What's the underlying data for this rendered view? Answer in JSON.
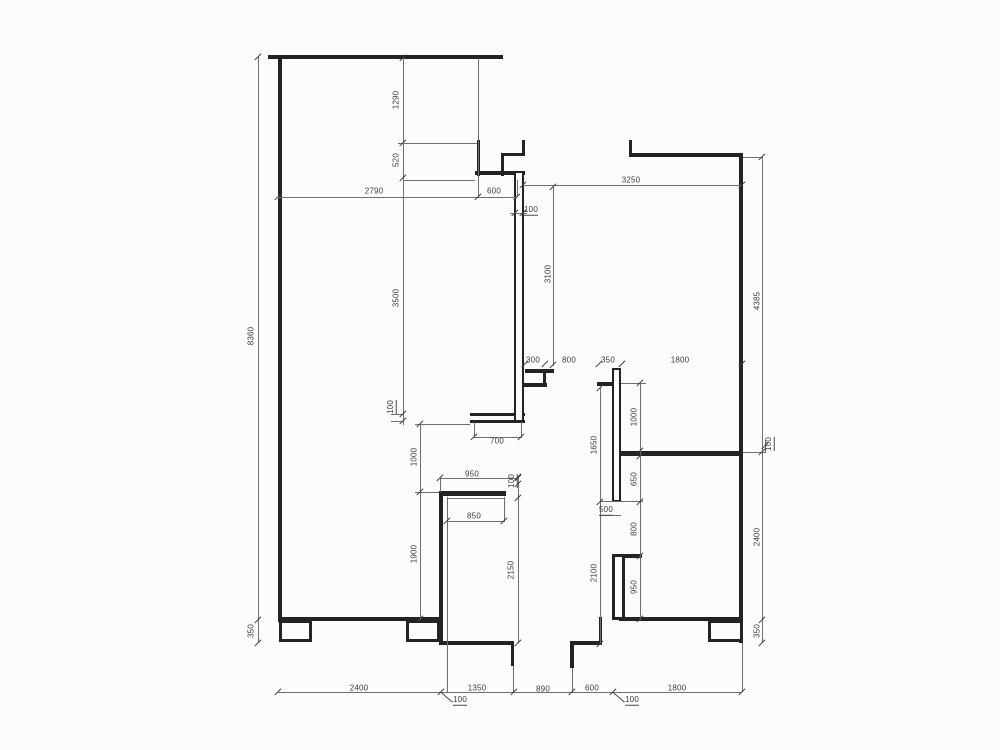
{
  "meta": {
    "drawing_type": "apartment-floor-plan-with-dimensions",
    "units": "mm"
  },
  "canvas": {
    "width": 1000,
    "height": 750,
    "background": "#fcfcfa",
    "wall_color": "#232323",
    "line_color": "#6e6e6e",
    "text_color": "#3c3c3c"
  },
  "plan": {
    "walls_h": [
      [
        268,
        55,
        503,
        4
      ],
      [
        501,
        153,
        525,
        3
      ],
      [
        475,
        171,
        525,
        4
      ],
      [
        629,
        153,
        743,
        4
      ],
      [
        470,
        413,
        525,
        3
      ],
      [
        470,
        420,
        525,
        2.5
      ],
      [
        525,
        369,
        554,
        3.5
      ],
      [
        523,
        383,
        547,
        3.5
      ],
      [
        597,
        382,
        621,
        3.5
      ],
      [
        618,
        451,
        743,
        4.5
      ],
      [
        612,
        554,
        642,
        3.5
      ],
      [
        439,
        491,
        506,
        4.5
      ],
      [
        443,
        641,
        514,
        3.5
      ],
      [
        570,
        641,
        602,
        3.5
      ],
      [
        278,
        617,
        441,
        4
      ],
      [
        619,
        617,
        743,
        4
      ]
    ],
    "walls_v": [
      [
        278,
        55,
        622,
        4
      ],
      [
        477,
        140,
        176,
        3
      ],
      [
        521.5,
        140,
        156,
        3
      ],
      [
        501,
        153,
        176,
        3
      ],
      [
        629,
        140,
        157,
        3
      ],
      [
        738.5,
        154,
        643,
        4.5
      ],
      [
        543,
        369,
        387,
        3
      ],
      [
        439,
        491,
        645,
        4
      ],
      [
        510.5,
        643,
        666,
        3.5
      ],
      [
        570,
        643,
        668,
        3.5
      ],
      [
        598.5,
        617,
        645,
        3.5
      ]
    ],
    "wall_boxes": [
      [
        514,
        171,
        10,
        251,
        2.5
      ],
      [
        612,
        368,
        9,
        134,
        2.5
      ],
      [
        612,
        554,
        13,
        66,
        3
      ],
      [
        279,
        620,
        33,
        22,
        3
      ],
      [
        406,
        620,
        34,
        22,
        3
      ],
      [
        708,
        620,
        35,
        22,
        3
      ]
    ],
    "ext_v": [
      [
        258,
        57,
        643
      ],
      [
        402.5,
        57,
        425
      ],
      [
        477.5,
        58,
        197
      ],
      [
        517,
        180,
        197
      ],
      [
        553,
        186,
        366
      ],
      [
        762,
        157,
        643
      ],
      [
        446.5,
        497,
        692
      ],
      [
        503.5,
        497,
        522
      ],
      [
        474,
        422,
        438
      ],
      [
        521,
        422,
        438
      ],
      [
        517.5,
        477,
        643
      ],
      [
        440,
        477,
        492
      ],
      [
        420,
        424,
        620
      ],
      [
        600,
        388,
        645
      ],
      [
        640,
        383,
        620
      ],
      [
        512.5,
        666,
        692
      ],
      [
        572,
        668,
        692
      ],
      [
        742,
        643,
        692
      ],
      [
        765,
        440,
        453
      ],
      [
        600,
        501,
        515
      ]
    ],
    "ext_h": [
      [
        278,
        196.5,
        517
      ],
      [
        523,
        184.5,
        742
      ],
      [
        403,
        179.5,
        475
      ],
      [
        398,
        143,
        477
      ],
      [
        743,
        156.5,
        763
      ],
      [
        743,
        452,
        765
      ],
      [
        621,
        383,
        646
      ],
      [
        415,
        424,
        470
      ],
      [
        415,
        492,
        439
      ],
      [
        440,
        477.5,
        517.5
      ],
      [
        447,
        497.5,
        504
      ],
      [
        447,
        520.5,
        504
      ],
      [
        474,
        437,
        521
      ],
      [
        391,
        414,
        403
      ],
      [
        391,
        421,
        403
      ],
      [
        510,
        213,
        527
      ],
      [
        600,
        501,
        643
      ],
      [
        600,
        514.5,
        620.5
      ],
      [
        278,
        692,
        742
      ]
    ],
    "ticks": [
      [
        258,
        57
      ],
      [
        258,
        620
      ],
      [
        258,
        643
      ],
      [
        402.5,
        58
      ],
      [
        402.5,
        143
      ],
      [
        402.5,
        178
      ],
      [
        402.5,
        414
      ],
      [
        402.5,
        421
      ],
      [
        278,
        197
      ],
      [
        477.5,
        197
      ],
      [
        517,
        197
      ],
      [
        523,
        185
      ],
      [
        742,
        185
      ],
      [
        553,
        187
      ],
      [
        553,
        365
      ],
      [
        762,
        157
      ],
      [
        762,
        452
      ],
      [
        762,
        620
      ],
      [
        762,
        643
      ],
      [
        765,
        446
      ],
      [
        514.5,
        213
      ],
      [
        522.5,
        213
      ],
      [
        474,
        437
      ],
      [
        521,
        437
      ],
      [
        525,
        364
      ],
      [
        545,
        364
      ],
      [
        599,
        364
      ],
      [
        622,
        364
      ],
      [
        742,
        364
      ],
      [
        640,
        383
      ],
      [
        640,
        451
      ],
      [
        640,
        456
      ],
      [
        640,
        502
      ],
      [
        640,
        556
      ],
      [
        640,
        619
      ],
      [
        600,
        388
      ],
      [
        600,
        502
      ],
      [
        600,
        644
      ],
      [
        517.5,
        477
      ],
      [
        517.5,
        484
      ],
      [
        517.5,
        498
      ],
      [
        517.5,
        643
      ],
      [
        440,
        478
      ],
      [
        517.5,
        478
      ],
      [
        447,
        520.5
      ],
      [
        504,
        520.5
      ],
      [
        420,
        424
      ],
      [
        420,
        492
      ],
      [
        420,
        619
      ],
      [
        278,
        692
      ],
      [
        441,
        692
      ],
      [
        514,
        692
      ],
      [
        572,
        692
      ],
      [
        613,
        692
      ],
      [
        742,
        692
      ]
    ],
    "leaders": [
      [
        441,
        692,
        15,
        40
      ],
      [
        613,
        692,
        15,
        40
      ]
    ],
    "labels": [
      {
        "t": "1290",
        "x": 396,
        "y": 100,
        "r": 1,
        "u": 0
      },
      {
        "t": "520",
        "x": 396,
        "y": 160,
        "r": 1,
        "u": 0
      },
      {
        "t": "2790",
        "x": 374,
        "y": 191,
        "r": 0,
        "u": 0
      },
      {
        "t": "600",
        "x": 494,
        "y": 191,
        "r": 0,
        "u": 0
      },
      {
        "t": "100",
        "x": 531,
        "y": 210,
        "r": 0,
        "u": 1
      },
      {
        "t": "3250",
        "x": 631,
        "y": 180,
        "r": 0,
        "u": 0
      },
      {
        "t": "3100",
        "x": 548,
        "y": 274,
        "r": 1,
        "u": 0
      },
      {
        "t": "4385",
        "x": 757,
        "y": 301,
        "r": 1,
        "u": 0
      },
      {
        "t": "8360",
        "x": 251,
        "y": 336,
        "r": 1,
        "u": 0
      },
      {
        "t": "3500",
        "x": 396,
        "y": 298,
        "r": 1,
        "u": 0
      },
      {
        "t": "100",
        "x": 391,
        "y": 407,
        "r": 1,
        "u": 1
      },
      {
        "t": "700",
        "x": 497,
        "y": 441,
        "r": 0,
        "u": 0
      },
      {
        "t": "300",
        "x": 533,
        "y": 360,
        "r": 0,
        "u": 0
      },
      {
        "t": "800",
        "x": 569,
        "y": 360,
        "r": 0,
        "u": 0
      },
      {
        "t": "350",
        "x": 608,
        "y": 360,
        "r": 0,
        "u": 0
      },
      {
        "t": "1800",
        "x": 680,
        "y": 360,
        "r": 0,
        "u": 0
      },
      {
        "t": "100",
        "x": 769,
        "y": 444,
        "r": 1,
        "u": 1
      },
      {
        "t": "1000",
        "x": 634,
        "y": 417,
        "r": 1,
        "u": 0
      },
      {
        "t": "650",
        "x": 634,
        "y": 479,
        "r": 1,
        "u": 0
      },
      {
        "t": "800",
        "x": 634,
        "y": 529,
        "r": 1,
        "u": 0
      },
      {
        "t": "950",
        "x": 634,
        "y": 587,
        "r": 1,
        "u": 0
      },
      {
        "t": "1650",
        "x": 594,
        "y": 445,
        "r": 1,
        "u": 0
      },
      {
        "t": "2100",
        "x": 594,
        "y": 573,
        "r": 1,
        "u": 0
      },
      {
        "t": "500",
        "x": 606,
        "y": 510,
        "r": 0,
        "u": 1
      },
      {
        "t": "2150",
        "x": 511,
        "y": 570,
        "r": 1,
        "u": 0
      },
      {
        "t": "950",
        "x": 472,
        "y": 474,
        "r": 0,
        "u": 0
      },
      {
        "t": "100",
        "x": 512,
        "y": 481,
        "r": 1,
        "u": 1
      },
      {
        "t": "850",
        "x": 474,
        "y": 516,
        "r": 0,
        "u": 0
      },
      {
        "t": "1000",
        "x": 414,
        "y": 457,
        "r": 1,
        "u": 0
      },
      {
        "t": "1900",
        "x": 414,
        "y": 554,
        "r": 1,
        "u": 0
      },
      {
        "t": "2400",
        "x": 757,
        "y": 537,
        "r": 1,
        "u": 0
      },
      {
        "t": "350",
        "x": 757,
        "y": 631,
        "r": 1,
        "u": 0
      },
      {
        "t": "350",
        "x": 251,
        "y": 631,
        "r": 1,
        "u": 0
      },
      {
        "t": "2400",
        "x": 359,
        "y": 688,
        "r": 0,
        "u": 0
      },
      {
        "t": "1350",
        "x": 477,
        "y": 688,
        "r": 0,
        "u": 0
      },
      {
        "t": "890",
        "x": 543,
        "y": 689,
        "r": 0,
        "u": 0
      },
      {
        "t": "600",
        "x": 592,
        "y": 688,
        "r": 0,
        "u": 0
      },
      {
        "t": "1800",
        "x": 677,
        "y": 688,
        "r": 0,
        "u": 0
      },
      {
        "t": "100",
        "x": 460,
        "y": 700,
        "r": 0,
        "u": 1
      },
      {
        "t": "100",
        "x": 632,
        "y": 700,
        "r": 0,
        "u": 1
      }
    ]
  }
}
